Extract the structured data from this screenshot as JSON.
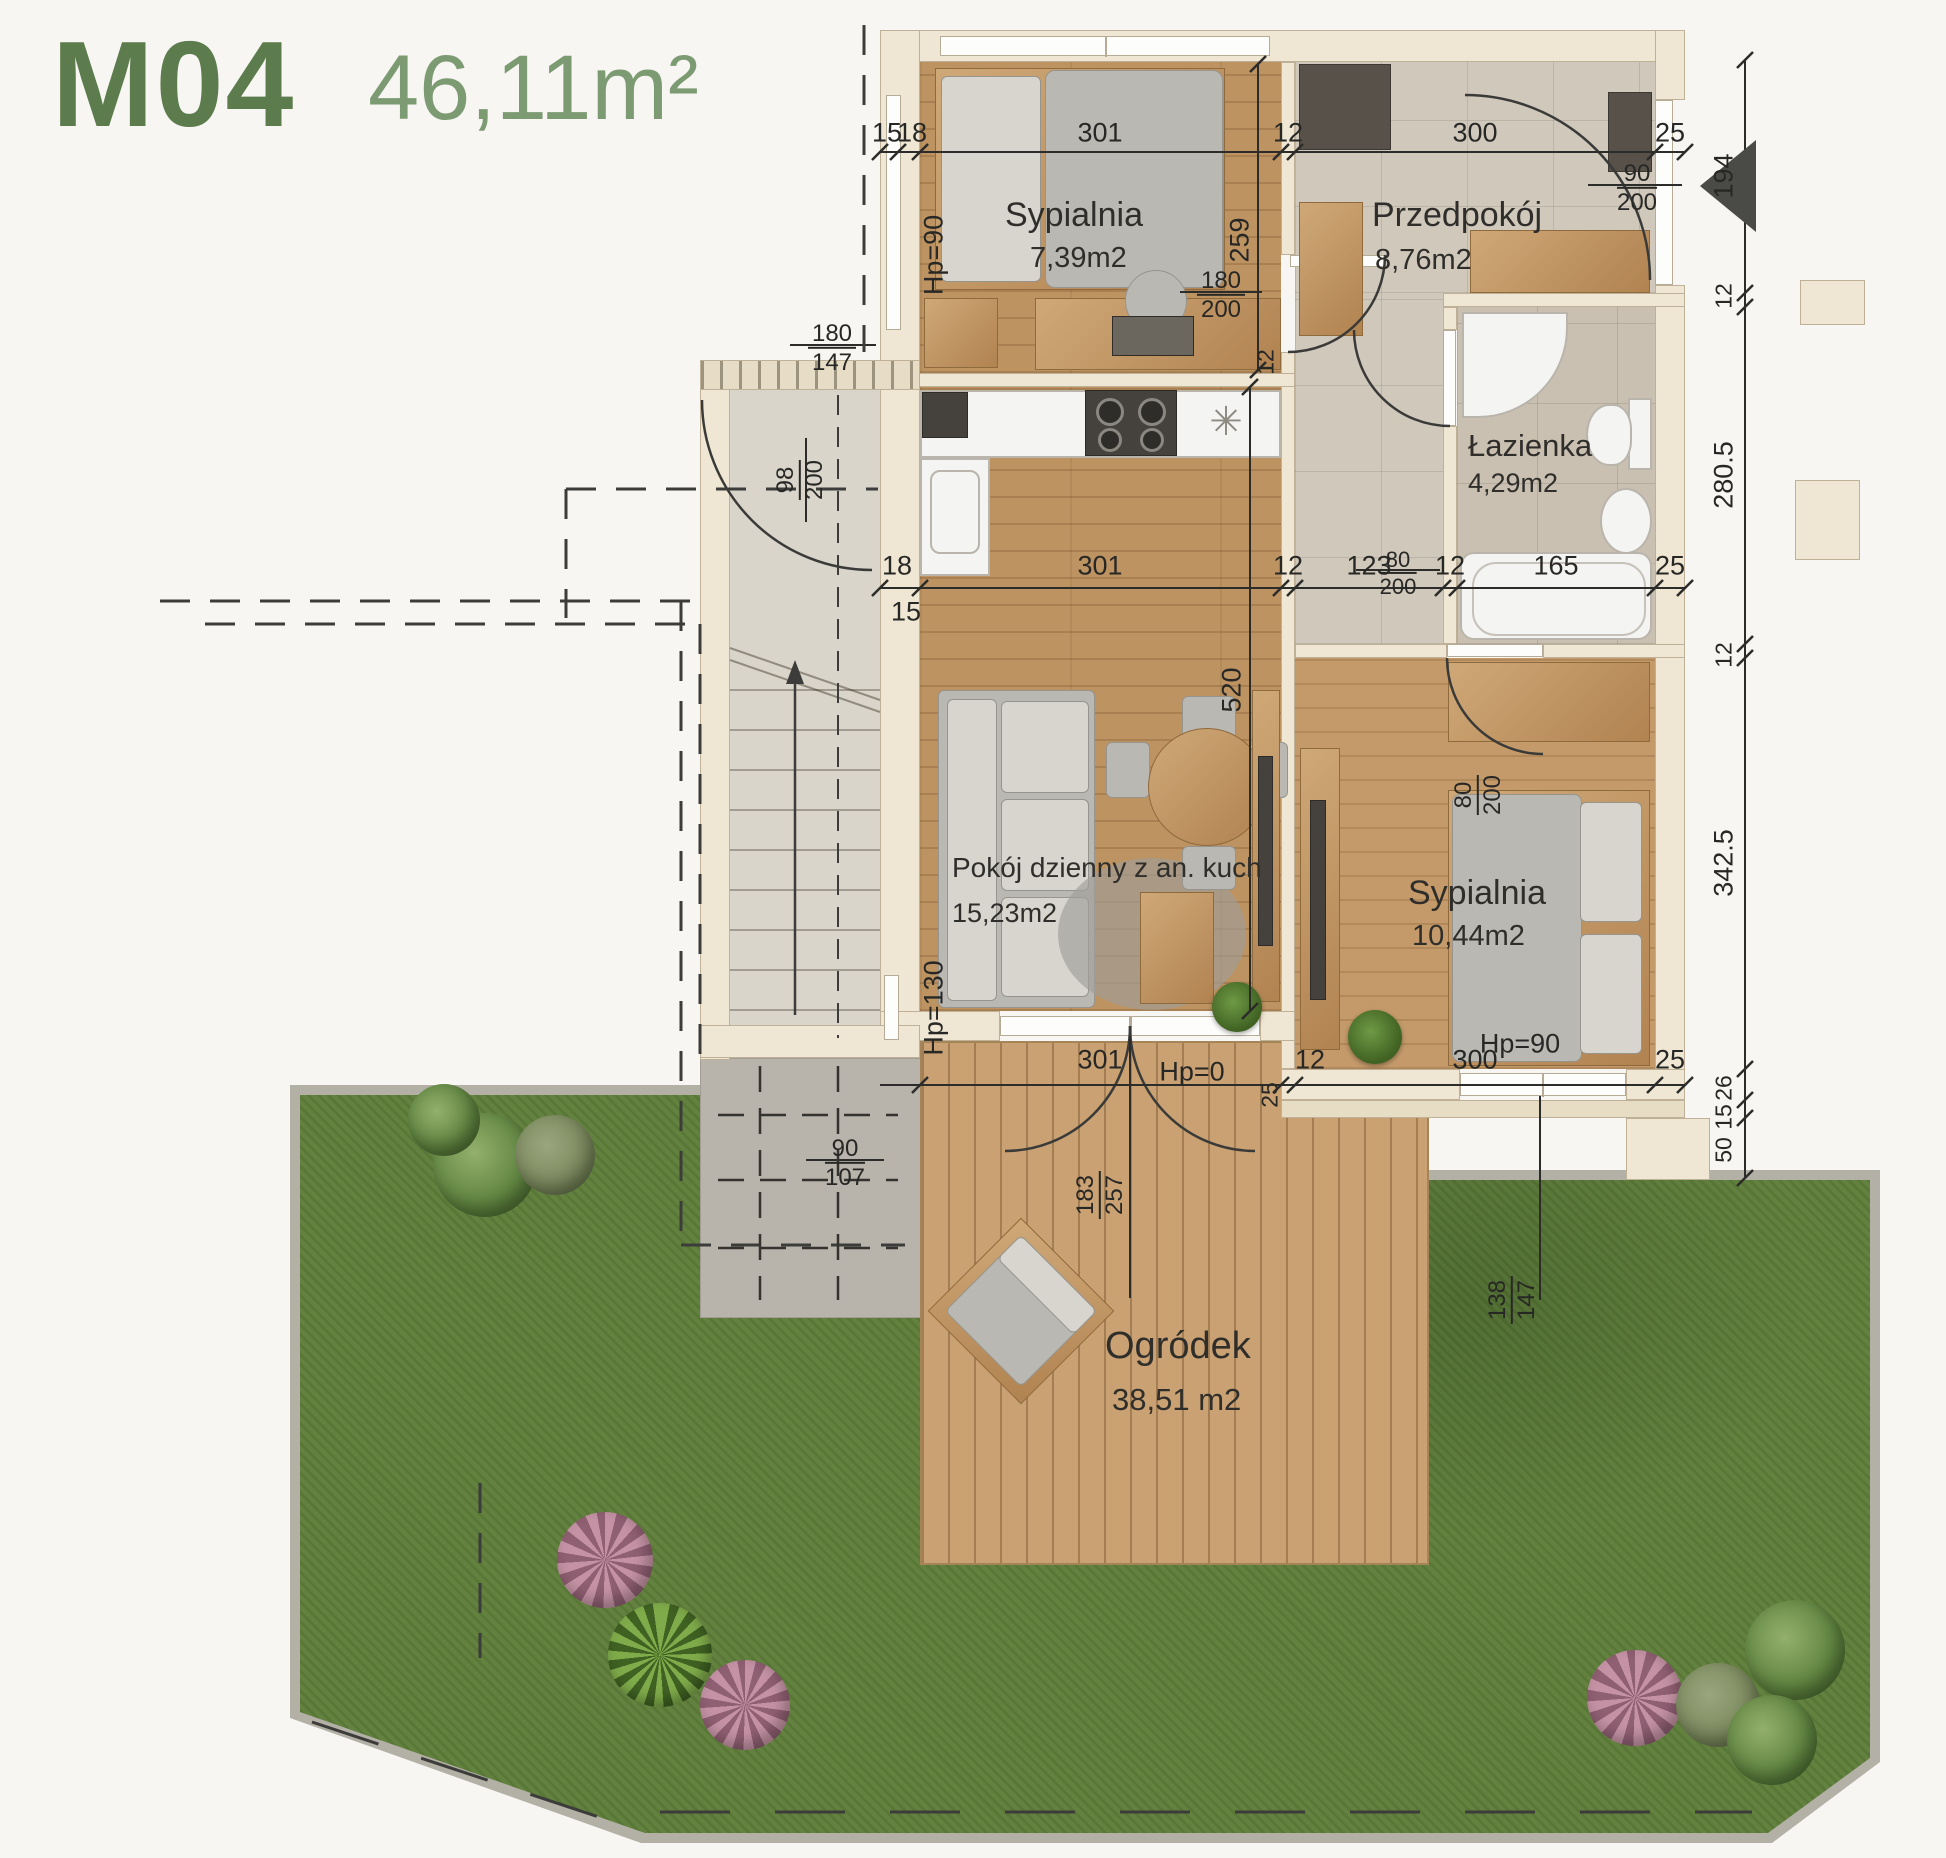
{
  "header": {
    "unit_id": "M04",
    "total_area": "46,11m²"
  },
  "rooms": {
    "bedroom1": {
      "name": "Sypialnia",
      "area": "7,39m2"
    },
    "hallway": {
      "name": "Przedpokój",
      "area": "8,76m2"
    },
    "bathroom": {
      "name": "Łazienka",
      "area": "4,29m2"
    },
    "living": {
      "name": "Pokój dzienny z an. kuch",
      "area": "15,23m2"
    },
    "bedroom2": {
      "name": "Sypialnia",
      "area": "10,44m2"
    },
    "garden": {
      "name": "Ogródek",
      "area": "38,51 m2"
    }
  },
  "dims": {
    "top": [
      "15",
      "18",
      "301",
      "12",
      "300",
      "25"
    ],
    "middle": {
      "wall_above": "18",
      "wall_below": "15",
      "seq": [
        "301",
        "12",
        "123",
        "12",
        "165",
        "25"
      ]
    },
    "bottom": [
      "301",
      "25",
      "12",
      "300",
      "25"
    ],
    "right": [
      "194",
      "12",
      "280.5",
      "12",
      "342.5",
      "26",
      "15",
      "50"
    ],
    "bedroom1_depth": "259",
    "living_depth": "520",
    "kitchen_wall": "12"
  },
  "openings": {
    "entrance": {
      "w": "90",
      "h": "200"
    },
    "bedroom1_door": {
      "w": "180",
      "h": "200"
    },
    "bathroom_door": {
      "w": "80",
      "h": "200"
    },
    "bedroom2_door": {
      "w": "80",
      "h": "200"
    },
    "stairwell_door": {
      "w": "98",
      "h": "200"
    },
    "bedroom1_window": {
      "w": "180",
      "h": "147",
      "hp": "Hp=90"
    },
    "living_window": {
      "w": "90",
      "h": "107",
      "hp": "Hp=130"
    },
    "terrace_door": {
      "w": "183",
      "h": "257",
      "hp": "Hp=0"
    },
    "bedroom2_window": {
      "w": "138",
      "h": "147",
      "hp": "Hp=90"
    }
  },
  "symbols": {
    "kitchen_star": "✳"
  },
  "colors": {
    "accent_green": "#5d7c4d",
    "accent_green_light": "#7d9b72",
    "wall": "#efe7d3",
    "wood": "#bd9362",
    "tile": "#cfc8bb",
    "grass": "#5e7e3a",
    "deck": "#c9a172"
  }
}
